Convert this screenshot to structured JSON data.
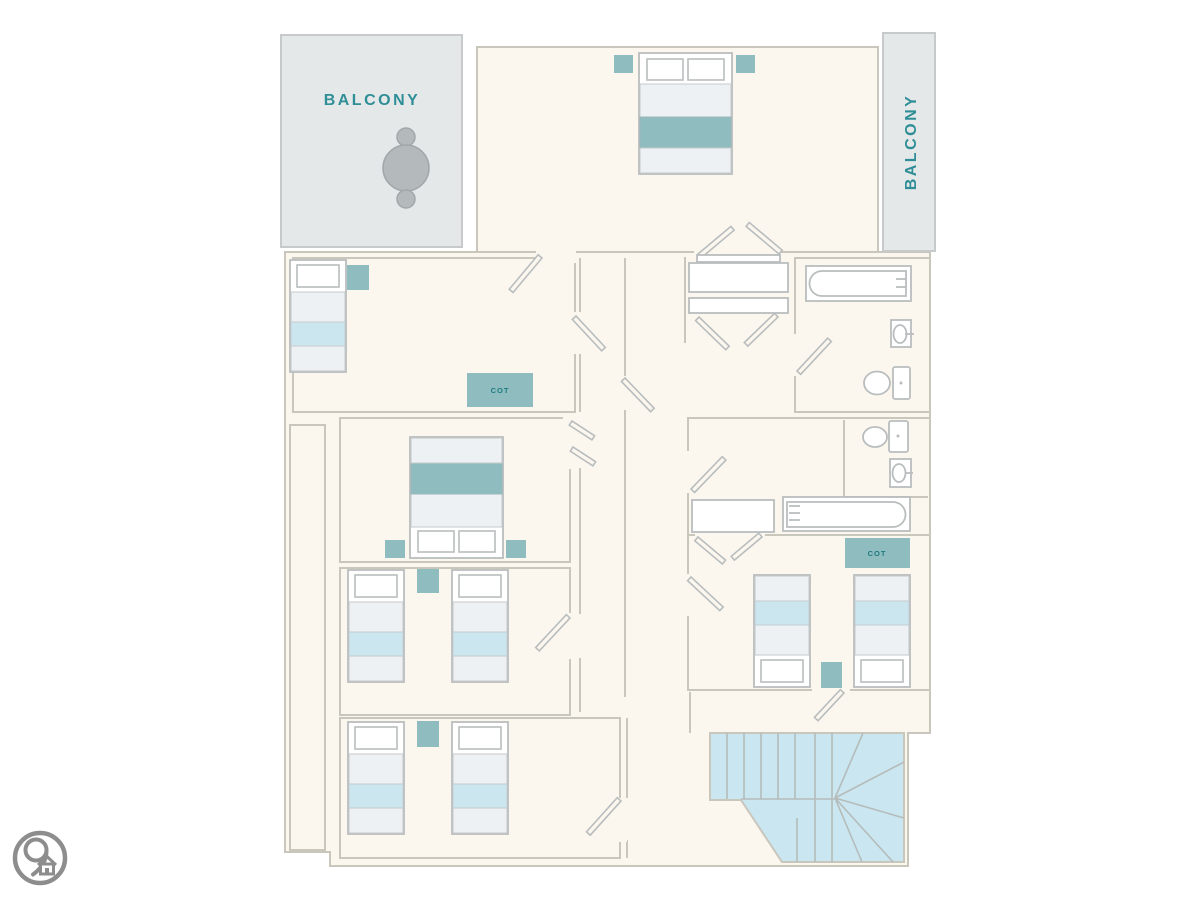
{
  "floorplan": {
    "balconies": [
      {
        "id": "balcony-left",
        "label": "BALCONY"
      },
      {
        "id": "balcony-right",
        "label": "BALCONY"
      }
    ],
    "cots": [
      {
        "id": "cot-left-room",
        "label": "COT"
      },
      {
        "id": "cot-right-room",
        "label": "COT"
      }
    ],
    "logo": {
      "icon": "map-pin-home-icon"
    },
    "colors": {
      "page": "#ffffff",
      "floor": "#fbf7ee",
      "wall": "#c9c6bc",
      "fixture": "#b9bdbe",
      "balcony": "#e4e8e9",
      "balcony-stroke": "#c6cacb",
      "teal": "#8fbdbf",
      "lightblue": "#cbe6ee",
      "bedgray": "#eef1f4",
      "stair": "#c9e6f1",
      "stairline": "#b5bcba",
      "label": "#2f8e96",
      "cotlabel": "#1f7a80",
      "logo": "#8d8d8d"
    }
  }
}
